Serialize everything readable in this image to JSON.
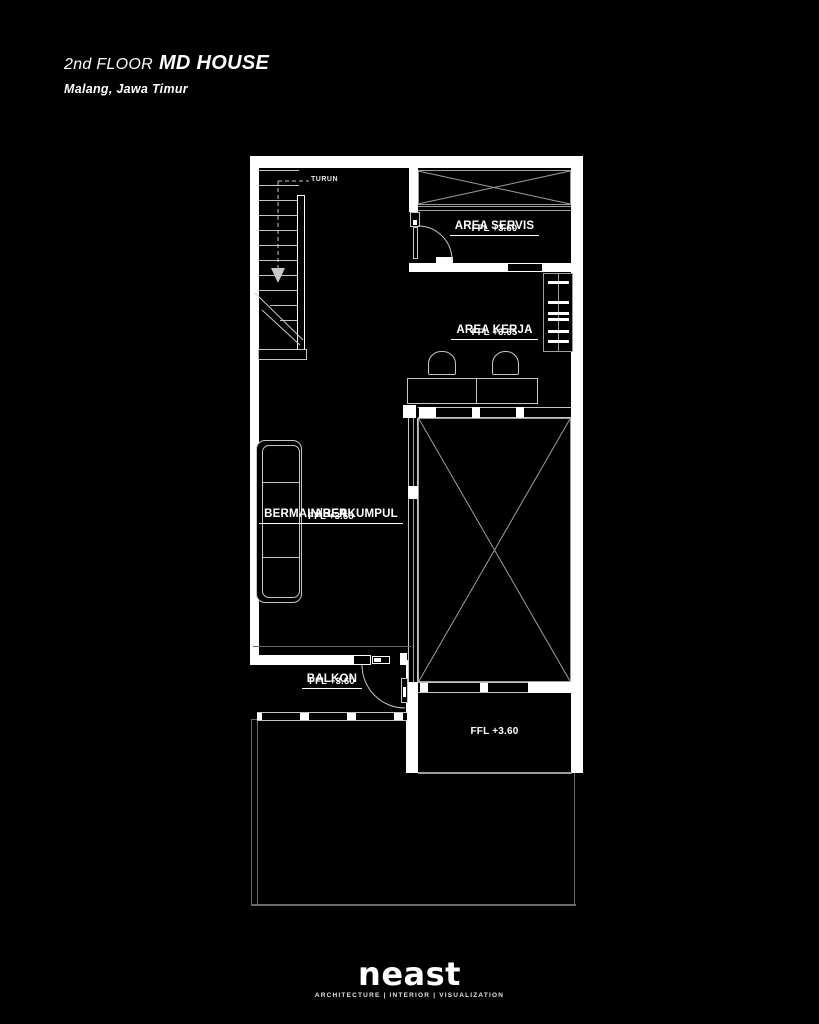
{
  "title": {
    "floor_label": "2nd FLOOR",
    "house_name": "MD HOUSE",
    "location": "Malang, Jawa Timur"
  },
  "stairs": {
    "direction_label": "TURUN"
  },
  "rooms": {
    "servis": {
      "name": "AREA SERVIS",
      "ffl": "FFL +3.60"
    },
    "kerja": {
      "name": "AREA KERJA",
      "ffl": "FFL +3.65"
    },
    "bermain": {
      "name_line1": "AREA",
      "name_line2": "BERMAIN/BERKUMPUL",
      "ffl": "FFL +3.65"
    },
    "balkon": {
      "name": "BALKON",
      "ffl": "FFL +3.60"
    },
    "lower": {
      "ffl": "FFL +3.60"
    }
  },
  "footer": {
    "logo": "neast",
    "tagline": "ARCHITECTURE | INTERIOR | VISUALIZATION"
  },
  "colors": {
    "bg": "#000000",
    "wall": "#ffffff",
    "line": "#9e9e9e",
    "lite": "#c6c6c6",
    "faint": "#6a6a6a",
    "text": "#ffffff"
  }
}
